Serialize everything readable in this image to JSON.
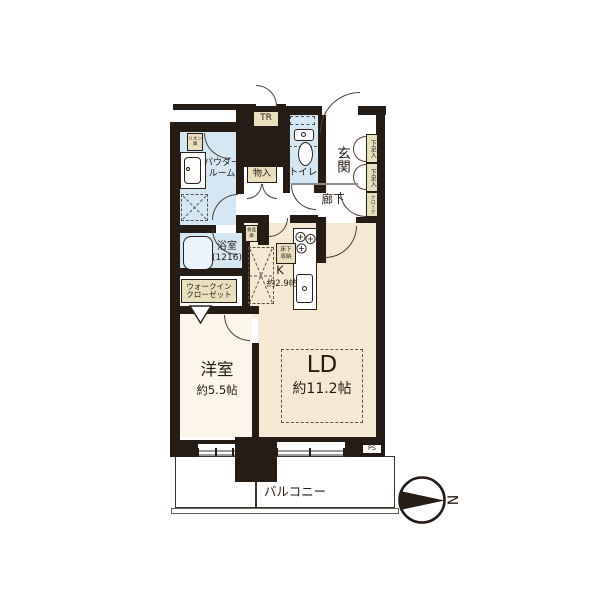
{
  "floorplan": {
    "compass_n": "N",
    "rooms": {
      "ld": {
        "name": "LD",
        "size": "約11.2帖"
      },
      "western_room": {
        "name": "洋室",
        "size": "約5.5帖"
      },
      "kitchen": {
        "name": "K",
        "size": "約2.9帖"
      },
      "powder_room": {
        "line1": "パウダー",
        "line2": "ルーム"
      },
      "bathroom": {
        "line1": "浴室",
        "line2": "(1216)"
      },
      "toilet": "トイレ",
      "entrance": "玄関",
      "hallway": "廊下",
      "balcony": "バルコニー",
      "walk_in_closet": {
        "line1": "ウォークイン",
        "line2": "クローゼット"
      }
    },
    "storage": {
      "trunk_room": "TR",
      "linen": {
        "line1": "リネン",
        "line2": "庫"
      },
      "closet": "物入",
      "pantry": {
        "line1": "食品",
        "line2": "庫"
      },
      "underfloor": {
        "line1": "床下",
        "line2": "収納"
      },
      "shoe_box_1": "下足入",
      "shoe_box_2": "下足入",
      "cloak": "クローク",
      "pipe_space": "PS"
    },
    "colors": {
      "wall": "#261c16",
      "water_area": "#d4e7f2",
      "living_floor": "#f6e9d4",
      "bedroom_floor": "#fcf6ea",
      "label_box": "#e9dfbe"
    }
  }
}
